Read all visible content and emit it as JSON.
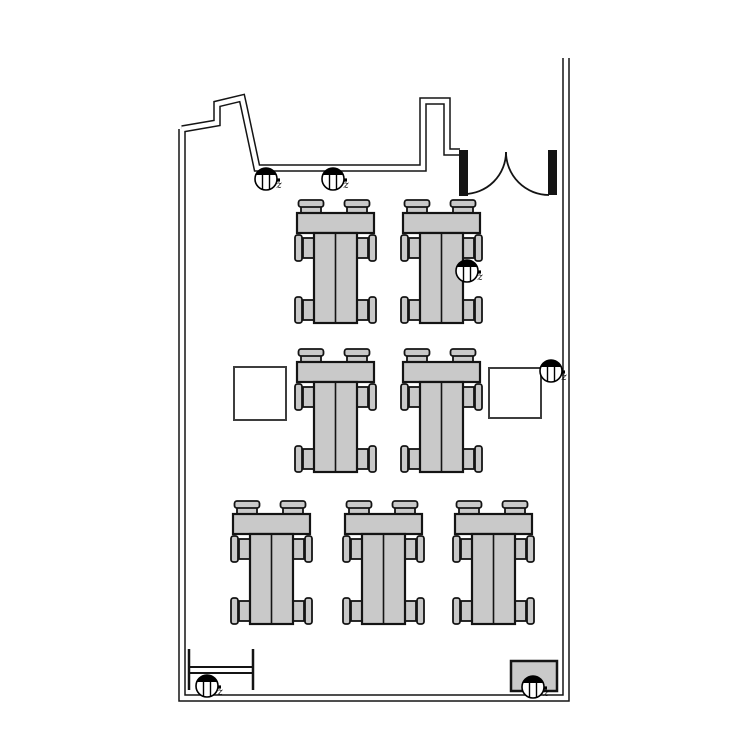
{
  "diagram": {
    "type": "floor-plan",
    "description": "Classroom floor plan with seven table groups, two side squares, a double door and six ceiling sensors labelled z",
    "canvas": {
      "w": 750,
      "h": 750,
      "bg": "#ffffff"
    },
    "colors": {
      "wall": "#141414",
      "line": "#141414",
      "furniture_fill": "#c9c9c9",
      "furniture_stroke": "#141414",
      "square_stroke": "#3d3d3d",
      "sensor": "#000000"
    },
    "walls": {
      "outer_width": 7.5,
      "inner_width": 4.5,
      "polylines": [
        [
          [
            182,
            129
          ],
          [
            182,
            698
          ],
          [
            566,
            698
          ],
          [
            566,
            58
          ]
        ],
        [
          [
            182,
            129
          ],
          [
            217,
            123
          ],
          [
            217,
            104
          ],
          [
            242,
            98
          ],
          [
            244,
            107
          ],
          [
            257,
            168
          ],
          [
            423,
            168
          ],
          [
            423,
            101
          ],
          [
            447,
            101
          ],
          [
            447,
            152
          ],
          [
            460,
            152
          ]
        ]
      ]
    },
    "door": {
      "jambs": [
        {
          "x": 459,
          "y": 150,
          "w": 9,
          "h": 46
        },
        {
          "x": 548,
          "y": 150,
          "w": 9,
          "h": 45
        }
      ],
      "arcs": [
        "M506,152 A42,42 0 0 1 464,194",
        "M506,152 A43,43 0 0 0 549,195"
      ]
    },
    "table_groups": {
      "template": {
        "top_table": {
          "x": 0,
          "y": 13,
          "w": 77,
          "h": 20
        },
        "vertical_table": {
          "x": 17,
          "y": 33,
          "w": 43,
          "h": 90
        },
        "divider_x": 38.5,
        "top_chair_centers_x": [
          14,
          60
        ],
        "side_chair_centers_y": [
          48,
          110
        ],
        "top_chair": {
          "seat_w": 20,
          "seat_h": 11,
          "back_w": 25,
          "back_h": 7
        },
        "side_chair": {
          "seat_w": 11,
          "seat_h": 20,
          "back_w": 7,
          "back_h": 26,
          "left_seat_x": 6,
          "left_back_x": -2,
          "right_seat_x": 60,
          "right_back_x": 72
        }
      },
      "positions": [
        {
          "x": 297,
          "y": 200
        },
        {
          "x": 403,
          "y": 200
        },
        {
          "x": 297,
          "y": 349
        },
        {
          "x": 403,
          "y": 349
        },
        {
          "x": 233,
          "y": 501
        },
        {
          "x": 345,
          "y": 501
        },
        {
          "x": 455,
          "y": 501
        }
      ]
    },
    "side_squares": [
      {
        "x": 234,
        "y": 367,
        "w": 52,
        "h": 53
      },
      {
        "x": 489,
        "y": 368,
        "w": 52,
        "h": 50
      }
    ],
    "radiator": {
      "x1": 189,
      "x2": 253,
      "rail_y1": 667,
      "rail_y2": 673,
      "cap_top": 649,
      "cap_bottom": 690
    },
    "cabinet": {
      "x": 511,
      "y": 661,
      "w": 46,
      "h": 30
    },
    "sensors": {
      "r": 11,
      "items": [
        {
          "cx": 266,
          "cy": 179,
          "label": "z"
        },
        {
          "cx": 333,
          "cy": 179,
          "label": "z"
        },
        {
          "cx": 467,
          "cy": 271,
          "label": "z"
        },
        {
          "cx": 551,
          "cy": 371,
          "label": "z"
        },
        {
          "cx": 207,
          "cy": 686,
          "label": "z"
        },
        {
          "cx": 533,
          "cy": 687,
          "label": "z"
        }
      ]
    }
  }
}
